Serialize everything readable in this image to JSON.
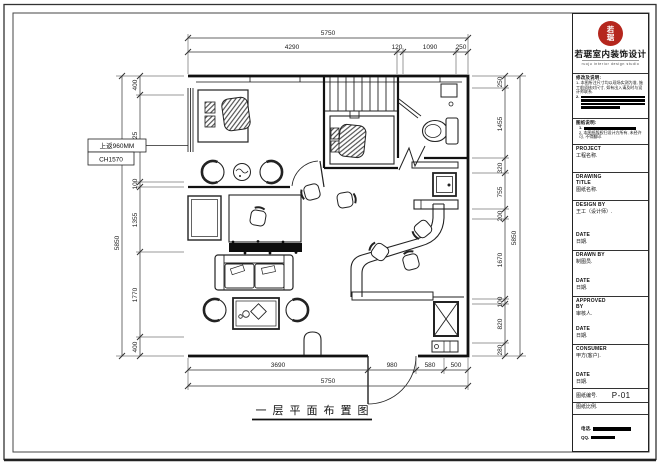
{
  "page": {
    "caption": "一层平面布置图"
  },
  "plan": {
    "annotation": {
      "line1": "上返960MM",
      "line2": "CH1570"
    }
  },
  "dimensions": {
    "top": {
      "overall": "5750",
      "seg": [
        "4290",
        "120",
        "1090",
        "250"
      ]
    },
    "bottom": {
      "overall": "5750",
      "seg": [
        "3690",
        "980",
        "580",
        "500"
      ]
    },
    "left": {
      "overall": "5850",
      "seg": [
        "400",
        "1825",
        "100",
        "1355",
        "1770",
        "400"
      ]
    },
    "right": {
      "overall": "5850",
      "seg": [
        "250",
        "1455",
        "320",
        "755",
        "200",
        "1670",
        "100",
        "820",
        "280"
      ]
    }
  },
  "title_block": {
    "logo": {
      "stamp_char1": "若",
      "stamp_char2": "琚",
      "company": "若琚室内装饰设计",
      "tagline": "ruoju interior design studio"
    },
    "notes1": {
      "heading": "修改及说明:",
      "item1": "1- 本图所注尺寸均以现场实测为准, 施工前须核对尺寸, 如有出入请及时与设计师联系.",
      "item2_no": "2."
    },
    "notes2": {
      "heading": "图纸说明:",
      "item1_no": "1.",
      "item2": "2. 本图纸版权归设计方所有, 未经许可, 不得翻印."
    },
    "project": {
      "label": "PROJECT",
      "value": "工程名称."
    },
    "drawing_title": {
      "label1": "DRAWING",
      "label2": "TITLE",
      "value": "图纸名称."
    },
    "design_by": {
      "label": "DESIGN  BY",
      "value": "王工（设计师）."
    },
    "date1": {
      "label": "DATE",
      "value": "日期."
    },
    "drawn_by": {
      "label": "DRAWN  BY",
      "value": "制图员."
    },
    "date2": {
      "label": "DATE",
      "value": "日期."
    },
    "approved_by": {
      "label1": "APPROVED",
      "label2": "BY",
      "value": "审核人."
    },
    "date3": {
      "label": "DATE",
      "value": "日期."
    },
    "consumer": {
      "label": "CONSUMER",
      "value": "甲方(客户)."
    },
    "date4": {
      "label": "DATE",
      "value": "日期."
    },
    "drawing_no": {
      "label": "图纸编号.",
      "value": "P-01"
    },
    "scale": {
      "label": "图纸比例."
    },
    "contact": {
      "phone_label": "电话.",
      "qq_label": "QQ."
    }
  },
  "colors": {
    "stamp_red": "#b5261d",
    "line_black": "#1a1a1a"
  }
}
